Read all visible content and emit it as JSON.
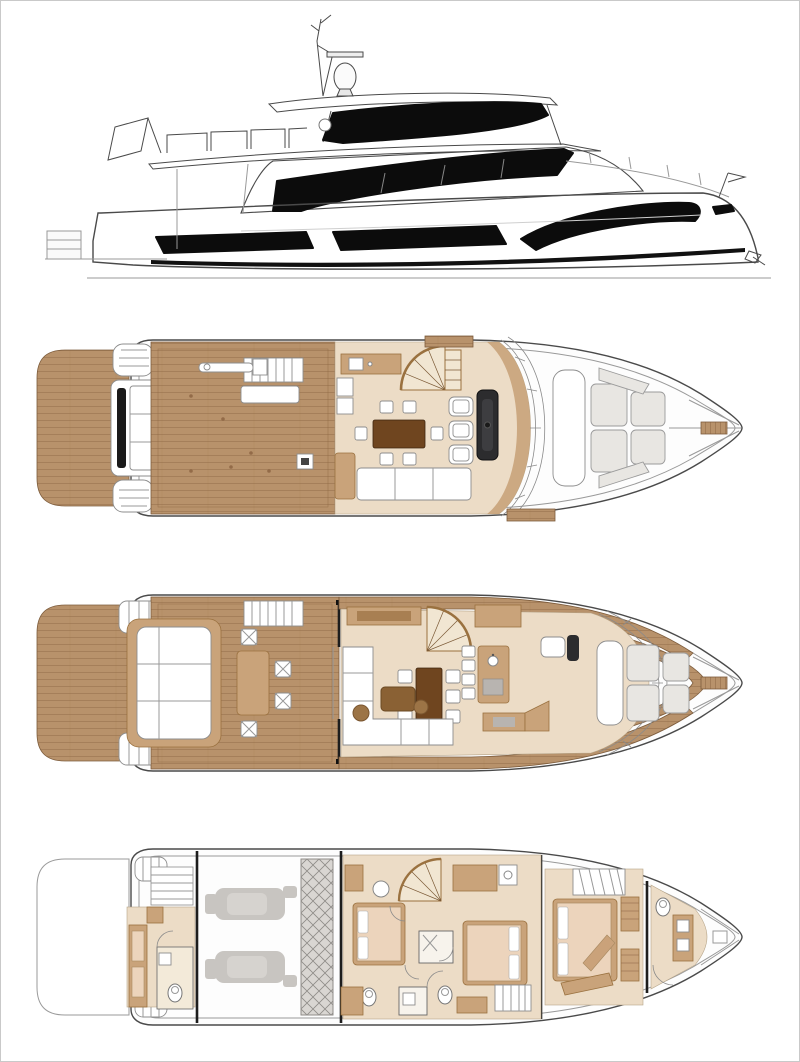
{
  "figure": {
    "title": "motor-yacht general-arrangement drawing",
    "views": {
      "profile": {
        "label": "starboard profile elevation of a three-deck motor yacht with radar mast, flybridge hardtop, black glazing bands and stern flag"
      },
      "flybridge": {
        "label": "flybridge deck plan: teak swim platform, teak aft deck, stairway, wet bar, spiral staircase, dining table with six chairs, sofa, three helm seats, console, bow sunpads and windlass"
      },
      "main": {
        "label": "main deck plan: swim platform, cockpit with transom sofa, table and four chairs, salon with L-sofa, coffee table, dining table with six chairs, galley island with stools, helm seat, bow lounge"
      },
      "lower": {
        "label": "lower deck plan: crew cabin with head, engine room with twin engines and tank, two guest cabins, amidships cabin, bathrooms, spiral stairs, forward cabin and ensuite head"
      }
    },
    "palette": {
      "paper": "#ffffff",
      "frame": "#c9c9c9",
      "line": "#4a4a4a",
      "line_soft": "#999999",
      "glass": "#0c0c0c",
      "hull_light": "#fdfdfd",
      "hull_mid": "#d9d9d9",
      "teak": "#b8926b",
      "teak_line": "#7d5c3c",
      "deck_white": "#f8f8f7",
      "floor": "#ecdcc6",
      "tan": "#c9a37a",
      "tan_dark": "#9a713f",
      "wood_dark": "#6f451f",
      "wood_mid": "#8a6134",
      "cushion": "#e8e6e2",
      "cushion_line": "#9a9a9a",
      "engine": "#c8c5c1",
      "tank": "#d9d6d2",
      "hatch_line": "#8f8c88",
      "console": "#2c2c2e",
      "stair": "#f1e6d2",
      "mattress": "#ecd4bc"
    }
  }
}
